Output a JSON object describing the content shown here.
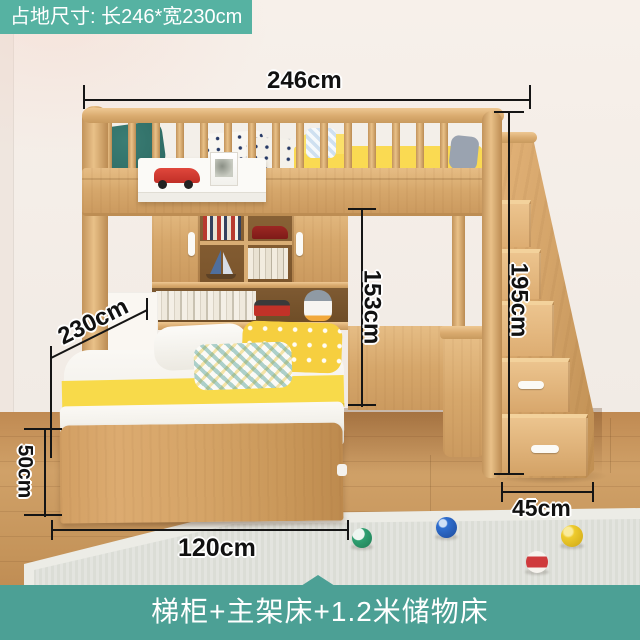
{
  "badge": {
    "label": "占地尺寸: 长246*宽230cm"
  },
  "caption": {
    "label": "梯柜+主架床+1.2米储物床"
  },
  "dims": {
    "total_width": "246cm",
    "total_depth": "230cm",
    "under_loft_height": "153cm",
    "overall_height": "195cm",
    "storage_bed_height": "50cm",
    "storage_bed_width": "120cm",
    "stair_cabinet_depth": "45cm"
  },
  "colors": {
    "accent_teal_badge": "#56b2a2",
    "accent_teal_bar": "#4ca095",
    "wood_light": "#e9c188",
    "wood_mid": "#d9aa6e",
    "wood_dark": "#c08f55",
    "floor": "#c99a61",
    "wall": "#f3ede7",
    "rug": "#dbddd6",
    "bedding_yellow": "#f8da4a",
    "pillow_teal": "#2f6e66",
    "toy_car_red": "#c8352c",
    "dimension_line": "#151515"
  },
  "toys": {
    "balls": [
      "green-white",
      "blue",
      "yellow",
      "red-stripe"
    ]
  }
}
